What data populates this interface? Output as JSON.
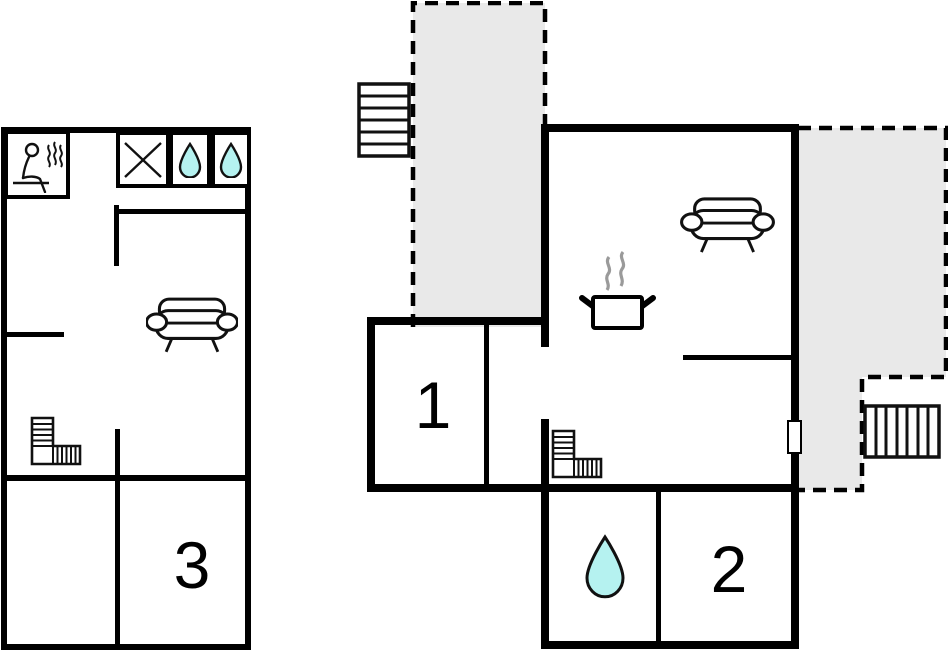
{
  "title": "Two-storey holiday house floor plan",
  "colors": {
    "wall": "#000000",
    "terrace_fill": "#e9e9e9",
    "water_fill": "#b5f2f0",
    "steam": "#9a9a9a",
    "outline_ink": "#111111",
    "background": "#ffffff"
  },
  "left_plan": {
    "name": "left building floor",
    "rooms": [
      {
        "id": "room-3",
        "label": "3"
      }
    ],
    "icons": [
      "sauna-icon",
      "shower-icon",
      "water-drop-icon",
      "water-drop-icon",
      "sofa-icon",
      "stairs-icon"
    ]
  },
  "right_plan": {
    "name": "right building floor",
    "rooms": [
      {
        "id": "room-1",
        "label": "1"
      },
      {
        "id": "room-2",
        "label": "2"
      }
    ],
    "icons": [
      "stairs-icon",
      "terrace-area",
      "cooking-pot-icon",
      "steam-icon",
      "sofa-icon",
      "stairs-icon",
      "water-drop-icon",
      "door-marker",
      "terrace-area",
      "stairs-icon"
    ]
  }
}
